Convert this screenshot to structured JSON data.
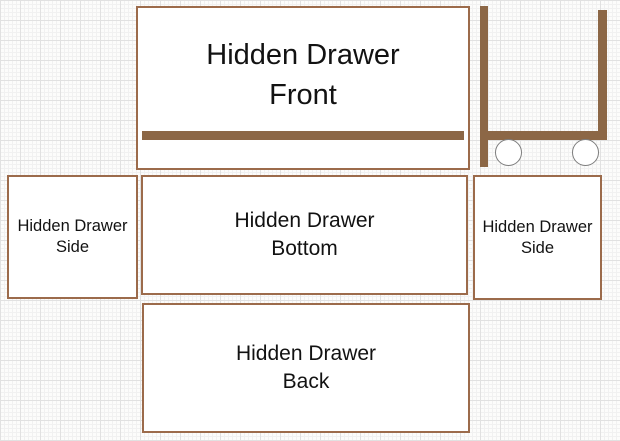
{
  "diagram_title": "Hidden Drawer parts plan",
  "panels": {
    "front": {
      "line1": "Hidden Drawer",
      "line2": "Front"
    },
    "side_left": {
      "line1": "Hidden Drawer",
      "line2": "Side"
    },
    "bottom": {
      "line1": "Hidden Drawer",
      "line2": "Bottom"
    },
    "side_right": {
      "line1": "Hidden Drawer",
      "line2": "Side"
    },
    "back": {
      "line1": "Hidden Drawer",
      "line2": "Back"
    }
  },
  "colors": {
    "panel_border": "#9c6b4b",
    "panel_fill": "#ffffff",
    "wood_bar": "#8c6746",
    "wheel_stroke": "#7d7d7d",
    "text": "#121212",
    "grid_minor": "#f1f1f1",
    "grid_major": "#e1e1e1",
    "background": "#fcfcfb"
  }
}
